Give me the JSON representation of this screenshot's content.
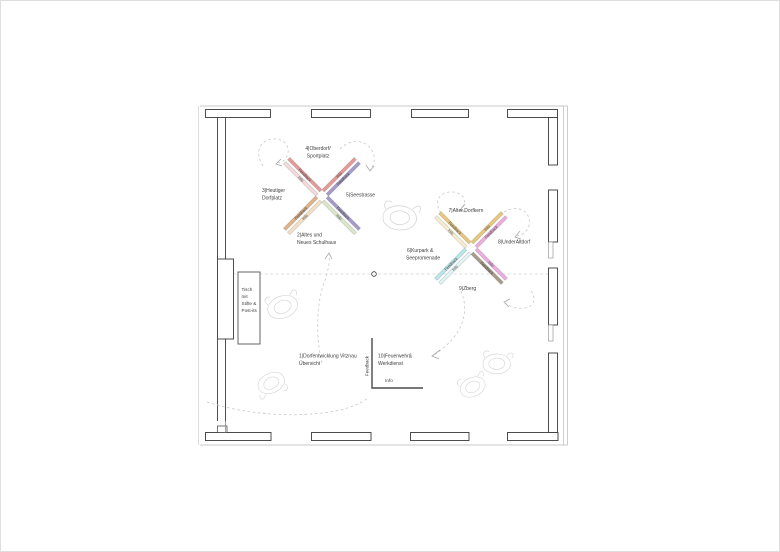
{
  "colors": {
    "salmon": "#e39a98",
    "purple": "#a59cc9",
    "tan": "#dfb287",
    "pale_pink": "#f3dbda",
    "pale_tan": "#f2e0c6",
    "pale_green": "#d9e8c8",
    "gold": "#e7c77c",
    "orchid": "#eaaede",
    "cyan": "#b7e6ec",
    "pale_gold": "#f6eccf",
    "pale_cyan": "#e0f4f6",
    "taupe": "#a89b8b",
    "wall": "#3a3a3a",
    "dash": "#c9c9c9",
    "sketch": "#d6d6d6",
    "text": "#404040"
  },
  "labels": {
    "feedback": "Feedback",
    "info": "Info"
  },
  "stations": {
    "s1": {
      "line1": "1|Dorfentwicklung Vitznau",
      "line2": "Übersicht"
    },
    "s2": {
      "line1": "2|Altes und",
      "line2": "Neues Schulhaus"
    },
    "s3": {
      "line1": "3|Heutiger",
      "line2": "Dorfplatz"
    },
    "s4": {
      "line1": "4|Oberdorf/",
      "line2": "Sportplatz"
    },
    "s5": {
      "line1": "5|Seestrasse"
    },
    "s6": {
      "line1": "6|Kurpark &",
      "line2": "Seepromenade"
    },
    "s7": {
      "line1": "7|Alter Dorfkern"
    },
    "s8": {
      "line1": "8|UnderAltdorf"
    },
    "s9": {
      "line1": "9|Zberg"
    },
    "s10": {
      "line1": "10|Feuerwehr&",
      "line2": "Werkdienst"
    }
  },
  "table": {
    "line1": "Tisch",
    "line2": "mit",
    "line3": "Stifte &",
    "line4": "Post-its"
  }
}
